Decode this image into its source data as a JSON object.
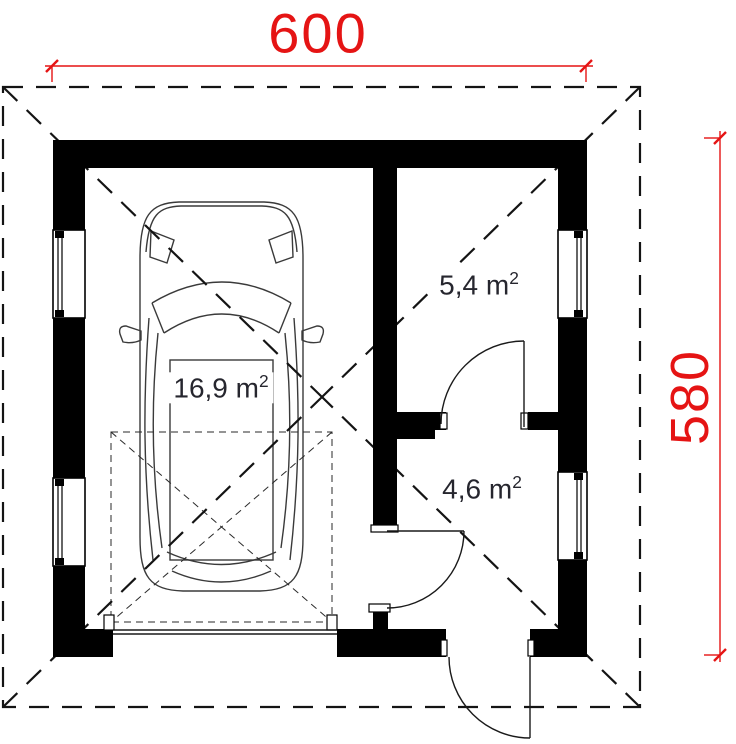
{
  "plan": {
    "type": "garage-floor-plan",
    "dimensions": {
      "horizontal": "600",
      "vertical": "580"
    },
    "rooms": [
      {
        "id": "garage",
        "area_full": "16,9 m²",
        "area_main": "16,9 m",
        "area_sup": "2"
      },
      {
        "id": "upper-right-room",
        "area_full": "5,4 m²",
        "area_main": "5,4 m",
        "area_sup": "2"
      },
      {
        "id": "lower-right-room",
        "area_full": "4,6 m²",
        "area_main": "4,6 m",
        "area_sup": "2"
      }
    ],
    "colors": {
      "dimension": "#e51414",
      "walls": "#000000",
      "room_label_text": "#26262e",
      "background": "#ffffff"
    }
  }
}
